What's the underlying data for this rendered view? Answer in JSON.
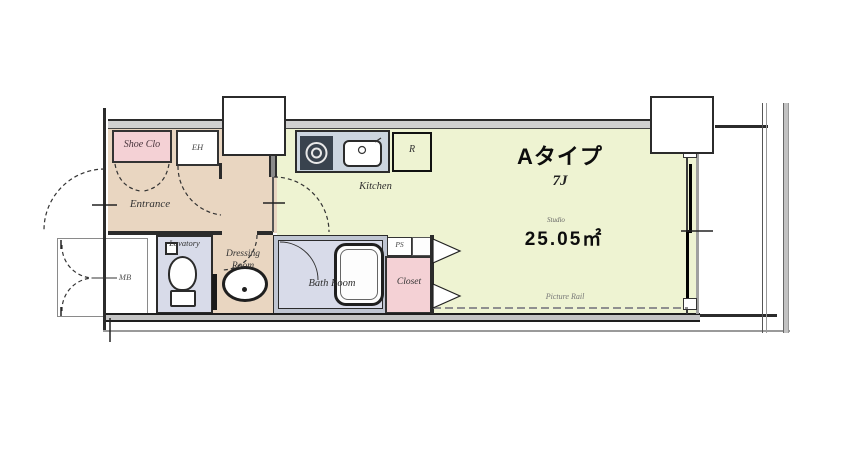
{
  "plan": {
    "labels": {
      "shoe_clo": "Shoe Clo",
      "eh": "EH",
      "kitchen": "Kitchen",
      "refrigerator": "R",
      "type": "Aタイプ",
      "tatami": "7J",
      "studio": "Studio",
      "area": "25.05㎡",
      "entrance": "Entrance",
      "lavatory": "Lavatory",
      "dressing_line1": "Dressing",
      "dressing_line2": "Room",
      "bath_room": "Bath Room",
      "pipe_space": "PS",
      "closet": "Closet",
      "meter_box": "MB",
      "picture_rail": "Picture Rail"
    },
    "colors": {
      "main_room": "#eef3d2",
      "entrance": "#e9d6c1",
      "closet_pink": "#f4d1d5",
      "bath_lavender": "#d8dbe9",
      "counter_gray": "#ccd5df",
      "wall_dark": "#2b2b2b"
    }
  }
}
